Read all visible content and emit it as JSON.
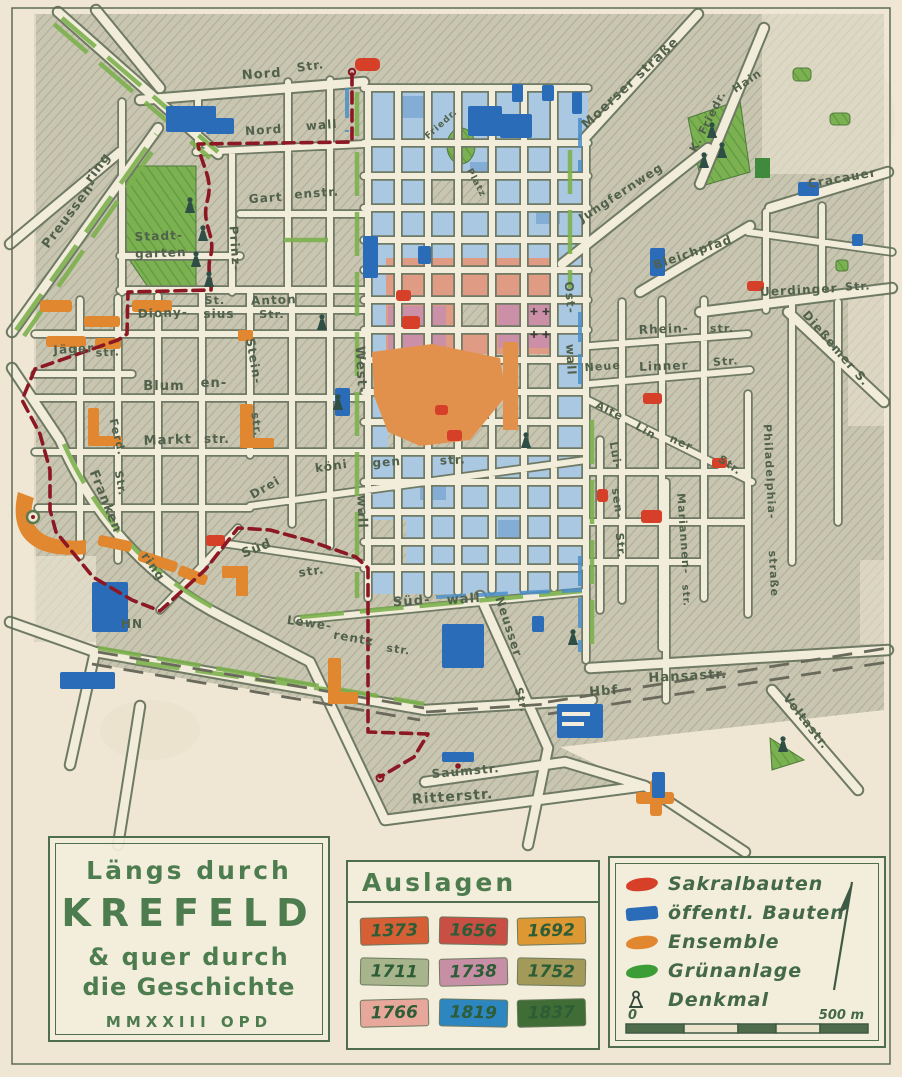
{
  "colors": {
    "paper": "#efe7d4",
    "ink_green": "#4d7c4f",
    "label_ink": "#51614b",
    "route_red": "#8c1823",
    "sakral": "#d63f28",
    "public": "#2b6cb8",
    "ensemble": "#e0872f",
    "green": "#3c9c35",
    "era_blue": "#aac8e2",
    "era_salmon": "#e09b85",
    "era_mauve": "#cb8fa8",
    "era_orange": "#e2914d"
  },
  "title_box": {
    "line1": "Längs durch",
    "line2": "KREFELD",
    "line3": "& quer durch",
    "line4": "die Geschichte",
    "line5": "MMXXIII OPD"
  },
  "auslagen": {
    "title": "Auslagen",
    "years": [
      {
        "value": "1373",
        "color": "#d65f35"
      },
      {
        "value": "1656",
        "color": "#c94f44"
      },
      {
        "value": "1692",
        "color": "#dd9833"
      },
      {
        "value": "1711",
        "color": "#a8b48c"
      },
      {
        "value": "1738",
        "color": "#c78fa6"
      },
      {
        "value": "1752",
        "color": "#a39a5a"
      },
      {
        "value": "1766",
        "color": "#e7a89b"
      },
      {
        "value": "1819",
        "color": "#2e86c1"
      },
      {
        "value": "1837",
        "color": "#3f6d35"
      }
    ]
  },
  "legend": {
    "items": [
      {
        "label": "Sakralbauten",
        "color": "#d63f28"
      },
      {
        "label": "öffentl. Bauten",
        "color": "#2b6cb8"
      },
      {
        "label": "Ensemble",
        "color": "#e0872f"
      },
      {
        "label": "Grünanlage",
        "color": "#3c9c35"
      },
      {
        "label": "Denkmal"
      }
    ],
    "scale_start": "0",
    "scale_end": "500 m"
  },
  "map": {
    "labels": {
      "nordstr_a": "Nord",
      "nordstr_b": "Str.",
      "nordwall_a": "Nord",
      "nordwall_b": "wall",
      "preussen": "Preussen-",
      "ring_top": "ring",
      "prinz": "Prinz-",
      "stadt": "Stadt-",
      "garten": "garten",
      "gart": "Gart",
      "enstr": "enstr.",
      "moerser": "Moerser straße",
      "jungfernweg": "Jungfernweg",
      "kfriedr": "K. Friedr.",
      "hain": "Hain",
      "cracauer": "Cracauer",
      "bleichpfad": "Bleichpfad",
      "uerdinger": "Uerdinger",
      "uerdinger_str": "Str.",
      "diessemer": "Dießemer S.",
      "diony": "Diony-",
      "sius": "sius",
      "st_anton_st": "St.",
      "anton": "Anton",
      "anton_str": "Str.",
      "stein": "Stein-",
      "stein_str": "str.",
      "jaeger": "Jäger",
      "jaeger_str": "str.",
      "blum": "Blum",
      "blum_en": "en-",
      "markt": "Markt",
      "markt_str": "str.",
      "ferd": "Ferd.",
      "ferd_str": "Str.",
      "franken": "Franken",
      "ring_sw": "ring",
      "westwall_a": "West-",
      "westwall_b": "wall",
      "drei": "Drei",
      "koeni": "köni",
      "gen": "gen",
      "drei_str": "str.",
      "sued": "Süd",
      "sued_str": "str.",
      "rhein": "Rhein-",
      "rhein_str": "str.",
      "neue": "Neue",
      "linner": "Linner",
      "linner_str": "Str.",
      "alte": "Alte",
      "lin": "Lin",
      "ner": "ner",
      "alte_str": "Str.",
      "lui": "Lui-",
      "sen": "sen-",
      "lui_str": "Str.",
      "mariannen": "Mariannen-",
      "mariannen_str": "str.",
      "phila": "Philadelphia-",
      "phila_str": "straße",
      "ost": "Ost-",
      "ostwall_b": "wall",
      "suedwall_a": "Süd-",
      "suedwall_b": "wall",
      "neusser": "Neusser",
      "neusser_str": "Str.",
      "lewe": "Lewe-",
      "rentz": "rentz",
      "lewe_str": "str.",
      "hn": "HN",
      "hbf": "Hbf",
      "hansastr": "Hansastr.",
      "voltastr": "Voltastr.",
      "saumstr": "Saumstr.",
      "ritterstr": "Ritterstr.",
      "friedr": "Friedr.",
      "platz": "Platz"
    }
  }
}
